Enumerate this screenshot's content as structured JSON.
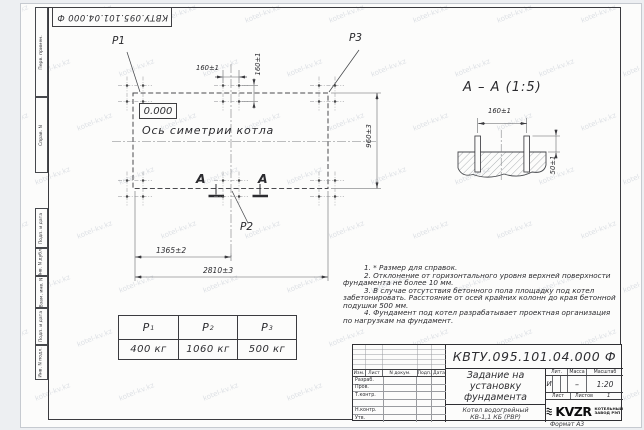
{
  "watermark": {
    "text": "kotel-kv.kz"
  },
  "side_strip": {
    "labels": [
      "Перв. примен.",
      "Справ. N",
      "Подп. и дата",
      "Инв. N дубл.",
      "Взам. инв. N",
      "Подп. и дата",
      "Инв. N подл."
    ]
  },
  "plan": {
    "point_labels": [
      "P1",
      "P2",
      "P3"
    ],
    "level_mark": "0.000",
    "symmetry_axis_label": "Ось симетрии котла",
    "section_letter": "А",
    "dims": {
      "bolt_spacing_x": "160±1",
      "bolt_spacing_y": "160±1",
      "foundation_width": "960±3",
      "left_to_center": "1365±2",
      "overall_length": "2810±3"
    }
  },
  "section_view": {
    "title": "А – А (1:5)",
    "dims": {
      "bolt_spacing": "160±1",
      "bolt_protrusion": "50±1"
    }
  },
  "notes": {
    "lines": [
      "1. * Размер для справок.",
      "2. Отклонение от горизонтального уровня верхней поверхности",
      "фундамента не более 10 мм.",
      "3. В случае отсутствия бетонного пола площадку под котел",
      "забетонировать. Расстояние от осей крайних колонн до края бетонной",
      "подушки 500 мм.",
      "4. Фундамент под котел разрабатывает проектная организация",
      "по нагрузкам на фундамент."
    ]
  },
  "load_table": {
    "headers": [
      {
        "symbol": "P",
        "index": "1"
      },
      {
        "symbol": "P",
        "index": "2"
      },
      {
        "symbol": "P",
        "index": "3"
      }
    ],
    "values": [
      "400 кг",
      "1060 кг",
      "500 кг"
    ]
  },
  "title_block": {
    "document_number": "КВТУ.095.101.04.000  Ф",
    "header_cells": [
      "Изм.",
      "Лист",
      "N докум.",
      "Подп.",
      "Дата"
    ],
    "signature_rows": [
      "Разраб.",
      "Пров.",
      "Т.контр.",
      "",
      "Н.контр.",
      "Утв."
    ],
    "title_lines": [
      "Задание на",
      "установку",
      "фундамента"
    ],
    "product_lines": [
      "Котел водогрейный",
      "КВ-1,1 КБ  (РВР)"
    ],
    "lit_header": "Лит.",
    "mass_header": "Масса",
    "scale_header": "Масштаб",
    "lit_value": "И",
    "mass_value": "–",
    "scale_value": "1:20",
    "sheet_label": "Лист",
    "sheets_label": "Листов",
    "sheets_value": "1",
    "logo_text": "KVZR",
    "company_lines": [
      "КОТЕЛЬНЫЙ",
      "ЗАВОД РЭП"
    ],
    "format_label": "Формат А3"
  }
}
